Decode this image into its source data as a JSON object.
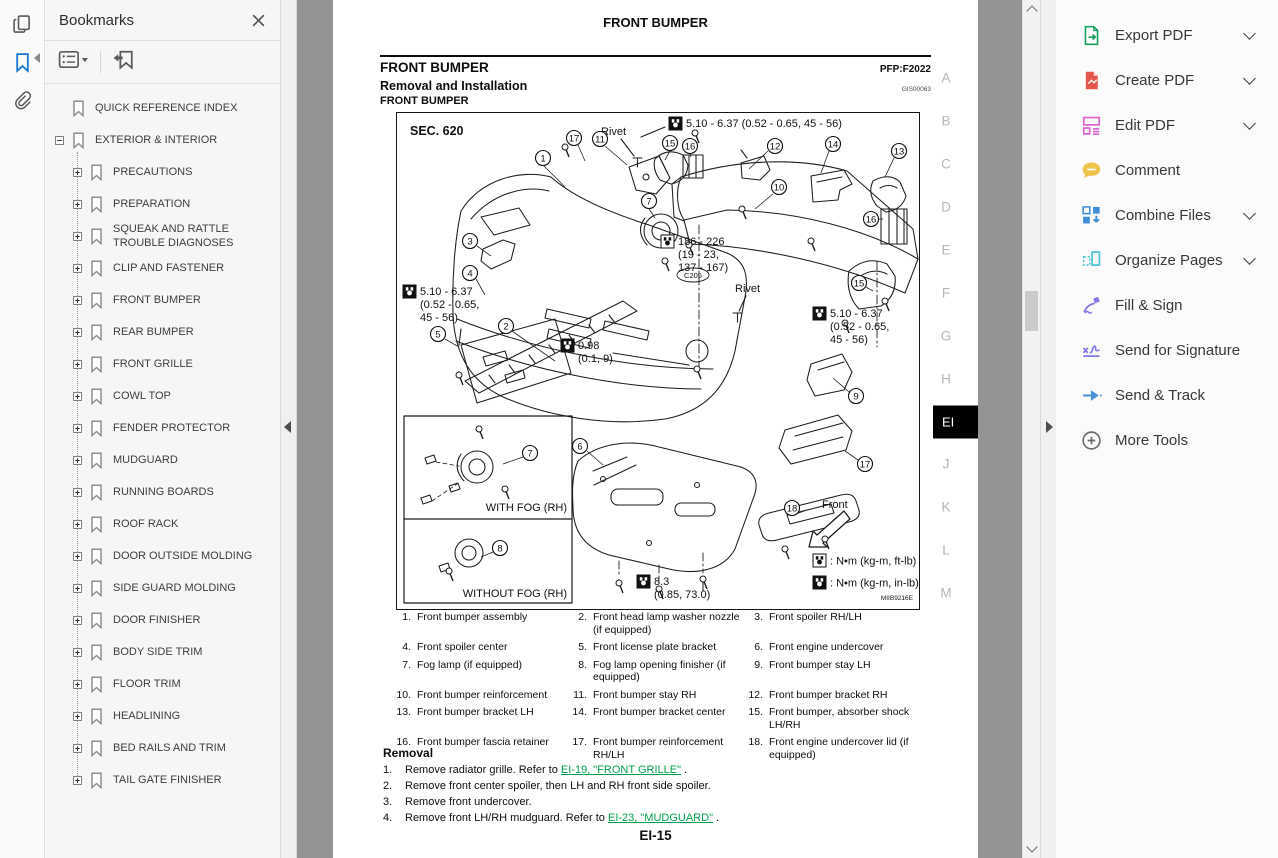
{
  "left_rail": {
    "icons": [
      {
        "name": "page-thumbnails",
        "active": false
      },
      {
        "name": "bookmarks",
        "active": true
      },
      {
        "name": "attachments",
        "active": false
      }
    ]
  },
  "bookmarks": {
    "title": "Bookmarks",
    "toolbar_icons": [
      "bookmark-options",
      "new-bookmark"
    ],
    "items": [
      {
        "label": "QUICK REFERENCE INDEX",
        "level": 0,
        "expander": null
      },
      {
        "label": "EXTERIOR & INTERIOR",
        "level": 0,
        "expander": "minus"
      },
      {
        "label": "PRECAUTIONS",
        "level": 1,
        "expander": "plus"
      },
      {
        "label": "PREPARATION",
        "level": 1,
        "expander": "plus"
      },
      {
        "label": "SQUEAK AND RATTLE TROUBLE DIAGNOSES",
        "level": 1,
        "expander": "plus"
      },
      {
        "label": "CLIP AND FASTENER",
        "level": 1,
        "expander": "plus"
      },
      {
        "label": "FRONT BUMPER",
        "level": 1,
        "expander": "plus"
      },
      {
        "label": "REAR BUMPER",
        "level": 1,
        "expander": "plus"
      },
      {
        "label": "FRONT GRILLE",
        "level": 1,
        "expander": "plus"
      },
      {
        "label": "COWL TOP",
        "level": 1,
        "expander": "plus"
      },
      {
        "label": "FENDER PROTECTOR",
        "level": 1,
        "expander": "plus"
      },
      {
        "label": "MUDGUARD",
        "level": 1,
        "expander": "plus"
      },
      {
        "label": "RUNNING BOARDS",
        "level": 1,
        "expander": "plus"
      },
      {
        "label": "ROOF RACK",
        "level": 1,
        "expander": "plus"
      },
      {
        "label": "DOOR OUTSIDE MOLDING",
        "level": 1,
        "expander": "plus"
      },
      {
        "label": "SIDE GUARD MOLDING",
        "level": 1,
        "expander": "plus"
      },
      {
        "label": "DOOR FINISHER",
        "level": 1,
        "expander": "plus"
      },
      {
        "label": "BODY SIDE TRIM",
        "level": 1,
        "expander": "plus"
      },
      {
        "label": "FLOOR TRIM",
        "level": 1,
        "expander": "plus"
      },
      {
        "label": "HEADLINING",
        "level": 1,
        "expander": "plus"
      },
      {
        "label": "BED RAILS AND TRIM",
        "level": 1,
        "expander": "plus"
      },
      {
        "label": "TAIL GATE FINISHER",
        "level": 1,
        "expander": "plus"
      }
    ]
  },
  "tools": {
    "items": [
      {
        "label": "Export PDF",
        "icon": "export-pdf",
        "color": "#169e5f",
        "chevron": true
      },
      {
        "label": "Create PDF",
        "icon": "create-pdf",
        "color": "#e4574d",
        "chevron": true
      },
      {
        "label": "Edit PDF",
        "icon": "edit-pdf",
        "color": "#dd63cf",
        "chevron": true
      },
      {
        "label": "Comment",
        "icon": "comment",
        "color": "#eec34c",
        "chevron": false
      },
      {
        "label": "Combine Files",
        "icon": "combine-files",
        "color": "#3f8fd8",
        "chevron": true
      },
      {
        "label": "Organize Pages",
        "icon": "organize-pages",
        "color": "#53c6d5",
        "chevron": true
      },
      {
        "label": "Fill & Sign",
        "icon": "fill-sign",
        "color": "#8379e8",
        "chevron": false
      },
      {
        "label": "Send for Signature",
        "icon": "send-signature",
        "color": "#8379e8",
        "chevron": false
      },
      {
        "label": "Send & Track",
        "icon": "send-track",
        "color": "#4a90d9",
        "chevron": false
      },
      {
        "label": "More Tools",
        "icon": "more-tools",
        "color": "#6d6d6d",
        "chevron": false
      }
    ]
  },
  "document": {
    "banner_title": "FRONT BUMPER",
    "section_heading": "FRONT BUMPER",
    "pfp_code": "PFP:F2022",
    "subsection_heading": "Removal and Installation",
    "gis_code": "GIS00063",
    "sub_subsection_heading": "FRONT BUMPER",
    "page_number": "EI-15",
    "letter_tabs": {
      "labels": [
        "A",
        "B",
        "C",
        "D",
        "E",
        "F",
        "G",
        "H",
        "EI",
        "J",
        "K",
        "L",
        "M"
      ],
      "active": "EI"
    },
    "diagram": {
      "sec_label": "SEC. 620",
      "figure_code": "MIIB9216E",
      "callouts": [
        {
          "n": "1",
          "x": 146,
          "y": 45
        },
        {
          "n": "2",
          "x": 109,
          "y": 213
        },
        {
          "n": "3",
          "x": 73,
          "y": 128
        },
        {
          "n": "4",
          "x": 73,
          "y": 160
        },
        {
          "n": "5",
          "x": 41,
          "y": 221
        },
        {
          "n": "6",
          "x": 183,
          "y": 333
        },
        {
          "n": "7",
          "x": 252,
          "y": 88
        },
        {
          "n": "7",
          "x": 133,
          "y": 340
        },
        {
          "n": "8",
          "x": 103,
          "y": 435
        },
        {
          "n": "9",
          "x": 459,
          "y": 283
        },
        {
          "n": "10",
          "x": 382,
          "y": 74
        },
        {
          "n": "11",
          "x": 203,
          "y": 26
        },
        {
          "n": "12",
          "x": 378,
          "y": 33
        },
        {
          "n": "13",
          "x": 502,
          "y": 38
        },
        {
          "n": "14",
          "x": 436,
          "y": 31
        },
        {
          "n": "15",
          "x": 273,
          "y": 30
        },
        {
          "n": "15",
          "x": 462,
          "y": 170
        },
        {
          "n": "16",
          "x": 293,
          "y": 33
        },
        {
          "n": "16",
          "x": 474,
          "y": 106
        },
        {
          "n": "17",
          "x": 177,
          "y": 25
        },
        {
          "n": "17",
          "x": 468,
          "y": 351
        },
        {
          "n": "18",
          "x": 395,
          "y": 395
        }
      ],
      "torque_notes": [
        {
          "style": "filled",
          "x": 272,
          "y": 4,
          "lines": [
            "5.10 - 6.37 (0.52 - 0.65, 45 - 56)"
          ]
        },
        {
          "style": "filled",
          "x": 6,
          "y": 172,
          "lines": [
            "5.10 - 6.37",
            "(0.52 - 0.65,",
            "45 - 56)"
          ]
        },
        {
          "style": "open",
          "x": 264,
          "y": 122,
          "lines": [
            "186 - 226",
            "(19 - 23,",
            "137 - 167)"
          ]
        },
        {
          "style": "filled",
          "x": 164,
          "y": 226,
          "lines": [
            "0.98",
            "(0.1, 9)"
          ]
        },
        {
          "style": "filled",
          "x": 416,
          "y": 194,
          "lines": [
            "5.10 - 6.37",
            "(0.52 - 0.65,",
            "45 - 56)"
          ]
        },
        {
          "style": "filled",
          "x": 240,
          "y": 462,
          "lines": [
            "8.3",
            "(0.85, 73.0)"
          ]
        }
      ],
      "labels": [
        {
          "text": "Rivet",
          "x": 204,
          "y": 22
        },
        {
          "text": "Rivet",
          "x": 338,
          "y": 179
        },
        {
          "text": "Front",
          "x": 425,
          "y": 395
        },
        {
          "text": "C205",
          "x": 296,
          "y": 165,
          "oval": true
        },
        {
          "text": "WITH FOG (RH)",
          "x": 170,
          "y": 398,
          "anchor": "end"
        },
        {
          "text": "WITHOUT FOG (RH)",
          "x": 170,
          "y": 484,
          "anchor": "end"
        }
      ],
      "legend": [
        {
          "style": "open",
          "text": ": N•m (kg-m, ft-lb)",
          "x": 416,
          "y": 441
        },
        {
          "style": "filled",
          "text": ": N•m (kg-m, in-lb)",
          "x": 416,
          "y": 463
        }
      ]
    },
    "parts_list": [
      {
        "n": "1.",
        "t": "Front bumper assembly"
      },
      {
        "n": "2.",
        "t": "Front head lamp washer nozzle (if equipped)"
      },
      {
        "n": "3.",
        "t": "Front spoiler RH/LH"
      },
      {
        "n": "4.",
        "t": "Front spoiler center"
      },
      {
        "n": "5.",
        "t": "Front license plate bracket"
      },
      {
        "n": "6.",
        "t": "Front engine undercover"
      },
      {
        "n": "7.",
        "t": "Fog lamp (if equipped)"
      },
      {
        "n": "8.",
        "t": "Fog lamp opening finisher (if equipped)"
      },
      {
        "n": "9.",
        "t": "Front bumper stay LH"
      },
      {
        "n": "10.",
        "t": "Front bumper reinforcement"
      },
      {
        "n": "11.",
        "t": "Front bumper stay RH"
      },
      {
        "n": "12.",
        "t": "Front bumper bracket RH"
      },
      {
        "n": "13.",
        "t": "Front bumper bracket LH"
      },
      {
        "n": "14.",
        "t": "Front bumper bracket center"
      },
      {
        "n": "15.",
        "t": "Front bumper, absorber shock LH/RH"
      },
      {
        "n": "16.",
        "t": "Front bumper fascia retainer"
      },
      {
        "n": "17.",
        "t": "Front bumper reinforcement RH/LH"
      },
      {
        "n": "18.",
        "t": "Front engine undercover lid (if equipped)"
      }
    ],
    "removal": {
      "heading": "Removal",
      "steps": [
        {
          "num": "1.",
          "segments": [
            {
              "text": "Remove radiator grille. Refer to "
            },
            {
              "text": "EI-19, \"FRONT GRILLE\"",
              "link": true
            },
            {
              "text": " ."
            }
          ]
        },
        {
          "num": "2.",
          "segments": [
            {
              "text": "Remove front center spoiler, then LH and RH front side spoiler."
            }
          ]
        },
        {
          "num": "3.",
          "segments": [
            {
              "text": "Remove front undercover."
            }
          ]
        },
        {
          "num": "4.",
          "segments": [
            {
              "text": "Remove front LH/RH mudguard. Refer to "
            },
            {
              "text": "EI-23, \"MUDGUARD\"",
              "link": true
            },
            {
              "text": " ."
            }
          ]
        }
      ]
    }
  }
}
